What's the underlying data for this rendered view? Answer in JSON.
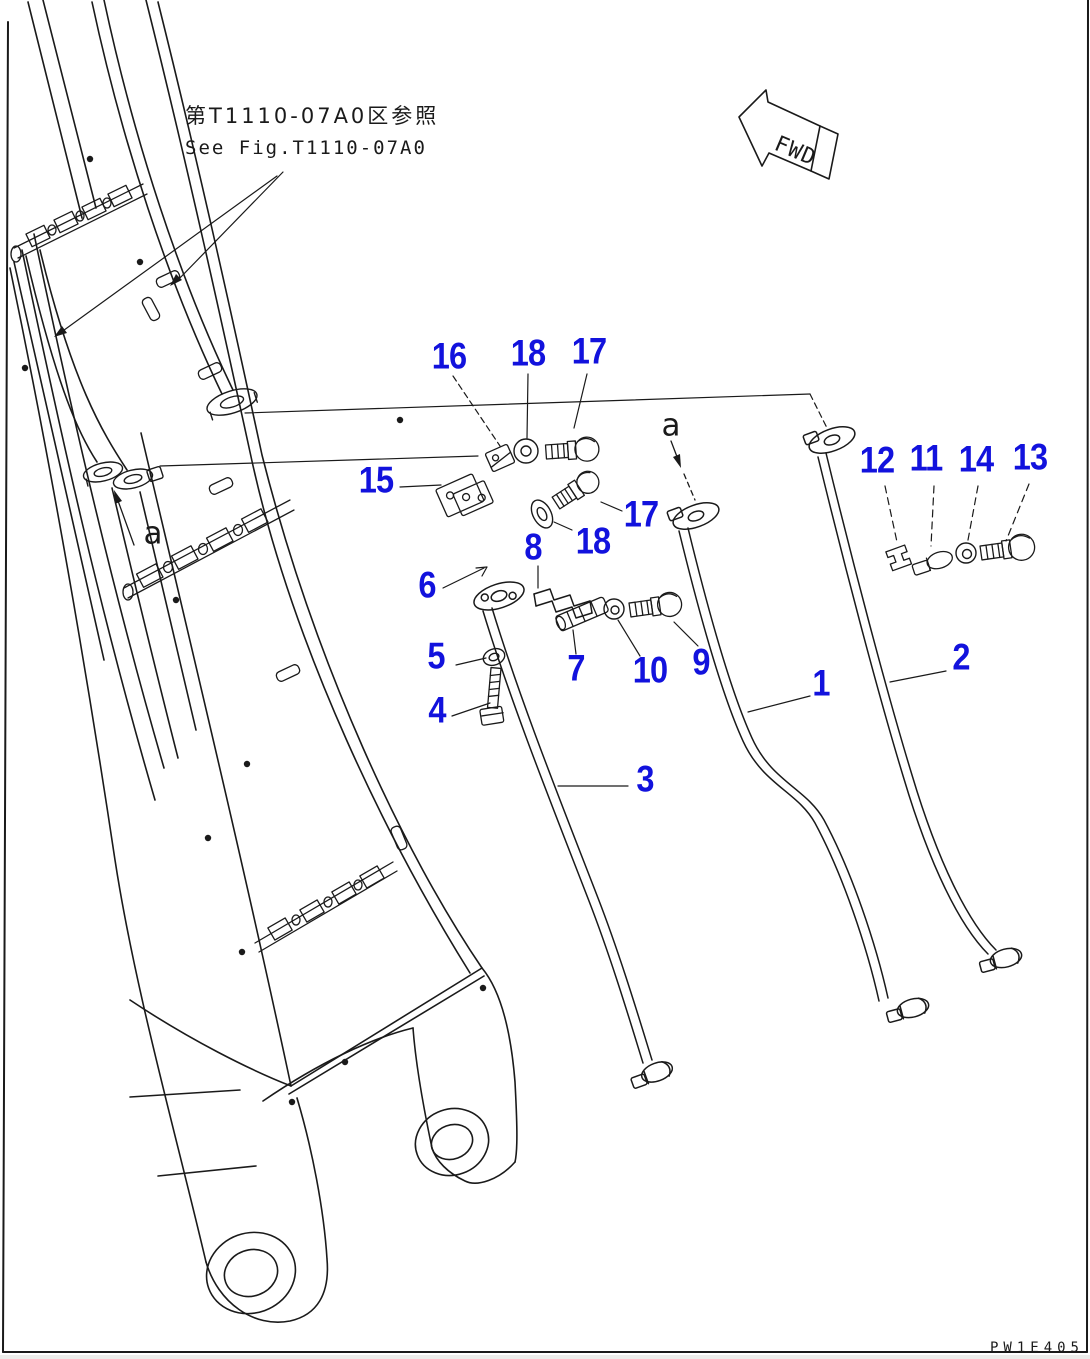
{
  "page": {
    "background": "#ffffff",
    "line_color": "#1a1a1a",
    "label_color": "#1212dd"
  },
  "reference_note": {
    "jp": "第T1110-07A0区参照",
    "en": "See Fig.T1110-07A0"
  },
  "direction_arrow": {
    "label": "FWD"
  },
  "drawing_code": "PW1E405",
  "section_labels": [
    {
      "text": "a"
    },
    {
      "text": "a"
    }
  ],
  "part_labels": [
    {
      "no": "16"
    },
    {
      "no": "18"
    },
    {
      "no": "17"
    },
    {
      "no": "15"
    },
    {
      "no": "17"
    },
    {
      "no": "18"
    },
    {
      "no": "8"
    },
    {
      "no": "6"
    },
    {
      "no": "5"
    },
    {
      "no": "4"
    },
    {
      "no": "7"
    },
    {
      "no": "10"
    },
    {
      "no": "9"
    },
    {
      "no": "12"
    },
    {
      "no": "11"
    },
    {
      "no": "14"
    },
    {
      "no": "13"
    },
    {
      "no": "1"
    },
    {
      "no": "2"
    },
    {
      "no": "3"
    }
  ]
}
